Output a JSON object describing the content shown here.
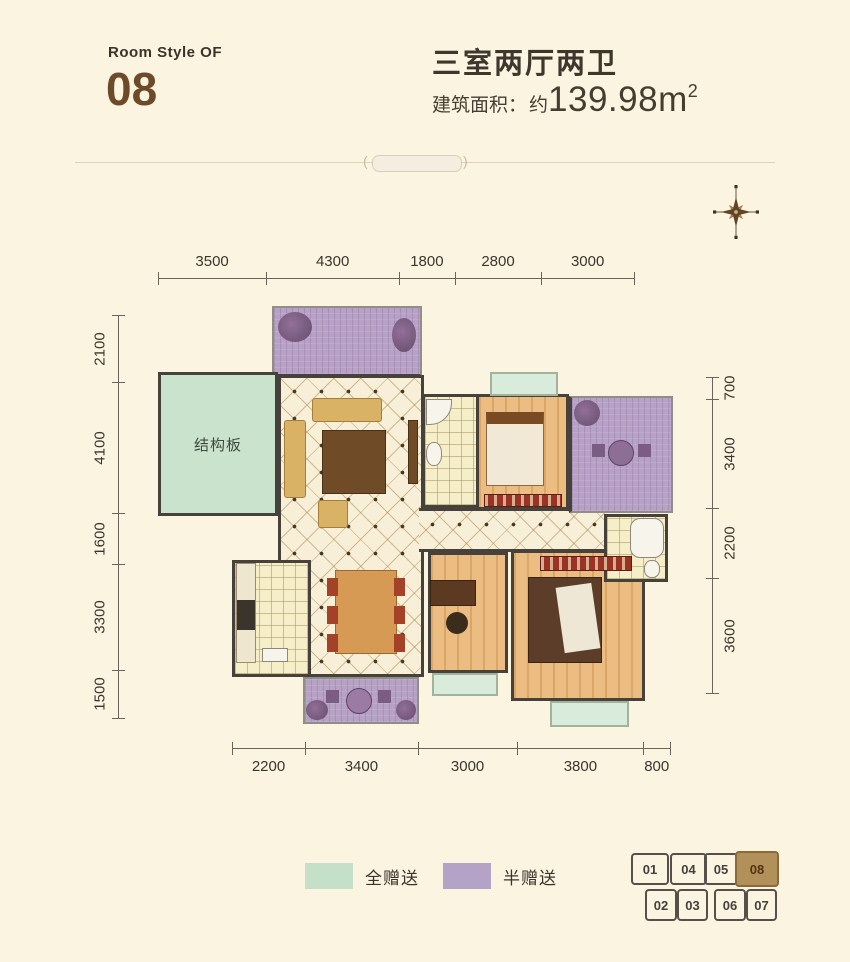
{
  "header": {
    "room_style_label": "Room Style OF",
    "room_number": "08",
    "title": "三室两厅两卫",
    "area_label": "建筑面积：",
    "area_approx": "约",
    "area_value": "139.98m",
    "area_sup": "2"
  },
  "floorplan": {
    "room_label": "结构板",
    "dims": {
      "top": [
        3500,
        4300,
        1800,
        2800,
        3000
      ],
      "bottom": [
        2200,
        3400,
        3000,
        3800,
        800
      ],
      "left": [
        2100,
        4100,
        1600,
        3300,
        1500
      ],
      "right": [
        700,
        3400,
        2200,
        3600
      ]
    }
  },
  "legend": [
    {
      "label": "全赠送",
      "color": "#c5e0c8"
    },
    {
      "label": "半赠送",
      "color": "#b4a3c7"
    }
  ],
  "keyplan": {
    "highlighted": "08",
    "top_row": [
      "01",
      "04",
      "05",
      "08"
    ],
    "bottom_row": [
      "02",
      "03",
      "06",
      "07"
    ]
  },
  "colors": {
    "background": "#fbf4e1",
    "accent_brown": "#6d4a28",
    "wall": "#46413a",
    "full_gift_green": "#c9e3cd",
    "half_gift_purple": "#b7a2c5",
    "highlight_unit": "#b2905a"
  }
}
